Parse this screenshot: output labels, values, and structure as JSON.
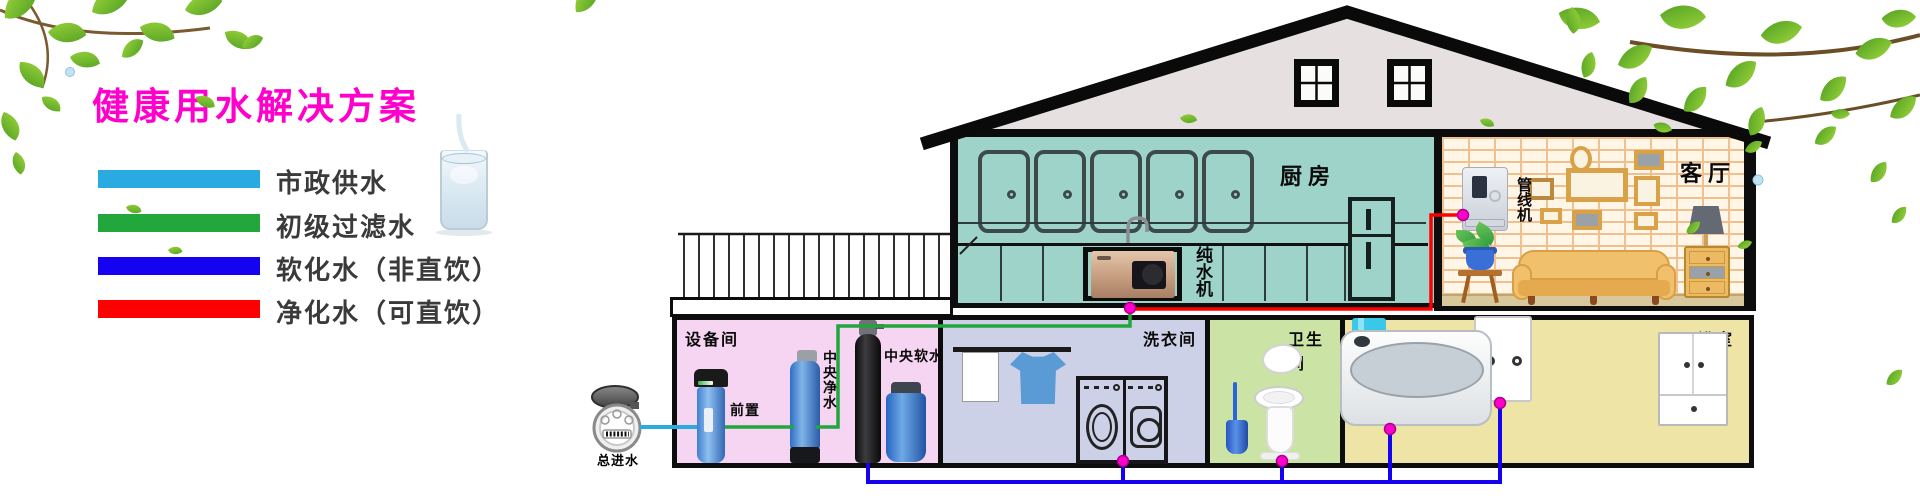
{
  "header": {
    "title": "健康用水解决方案",
    "title_color": "#FF00CC"
  },
  "legend": {
    "items": [
      {
        "label": "市政供水",
        "color": "#29ABE2"
      },
      {
        "label": "初级过滤水",
        "color": "#21A73C"
      },
      {
        "label": "软化水（非直饮）",
        "color": "#1502F0"
      },
      {
        "label": "净化水（可直饮）",
        "color": "#FF0000"
      }
    ]
  },
  "supply": {
    "meter_label": "总进水"
  },
  "house": {
    "kitchen": {
      "label": "厨房",
      "machine_label": "纯水机"
    },
    "living": {
      "label": "客厅",
      "machine_label": "管线机"
    },
    "equipment": {
      "label": "设备间",
      "prefilter_label": "前置",
      "purifier_label": "中央净水",
      "softener_label": "中央软水"
    },
    "laundry": {
      "label": "洗衣间"
    },
    "toilet": {
      "label": "卫生间"
    },
    "bath": {
      "label": "浴室"
    }
  },
  "pipe_colors": {
    "municipal": "#29ABE2",
    "filtered": "#21A73C",
    "softened": "#1502F0",
    "purified": "#FF0000",
    "junction_dot": "#FF00CC"
  }
}
